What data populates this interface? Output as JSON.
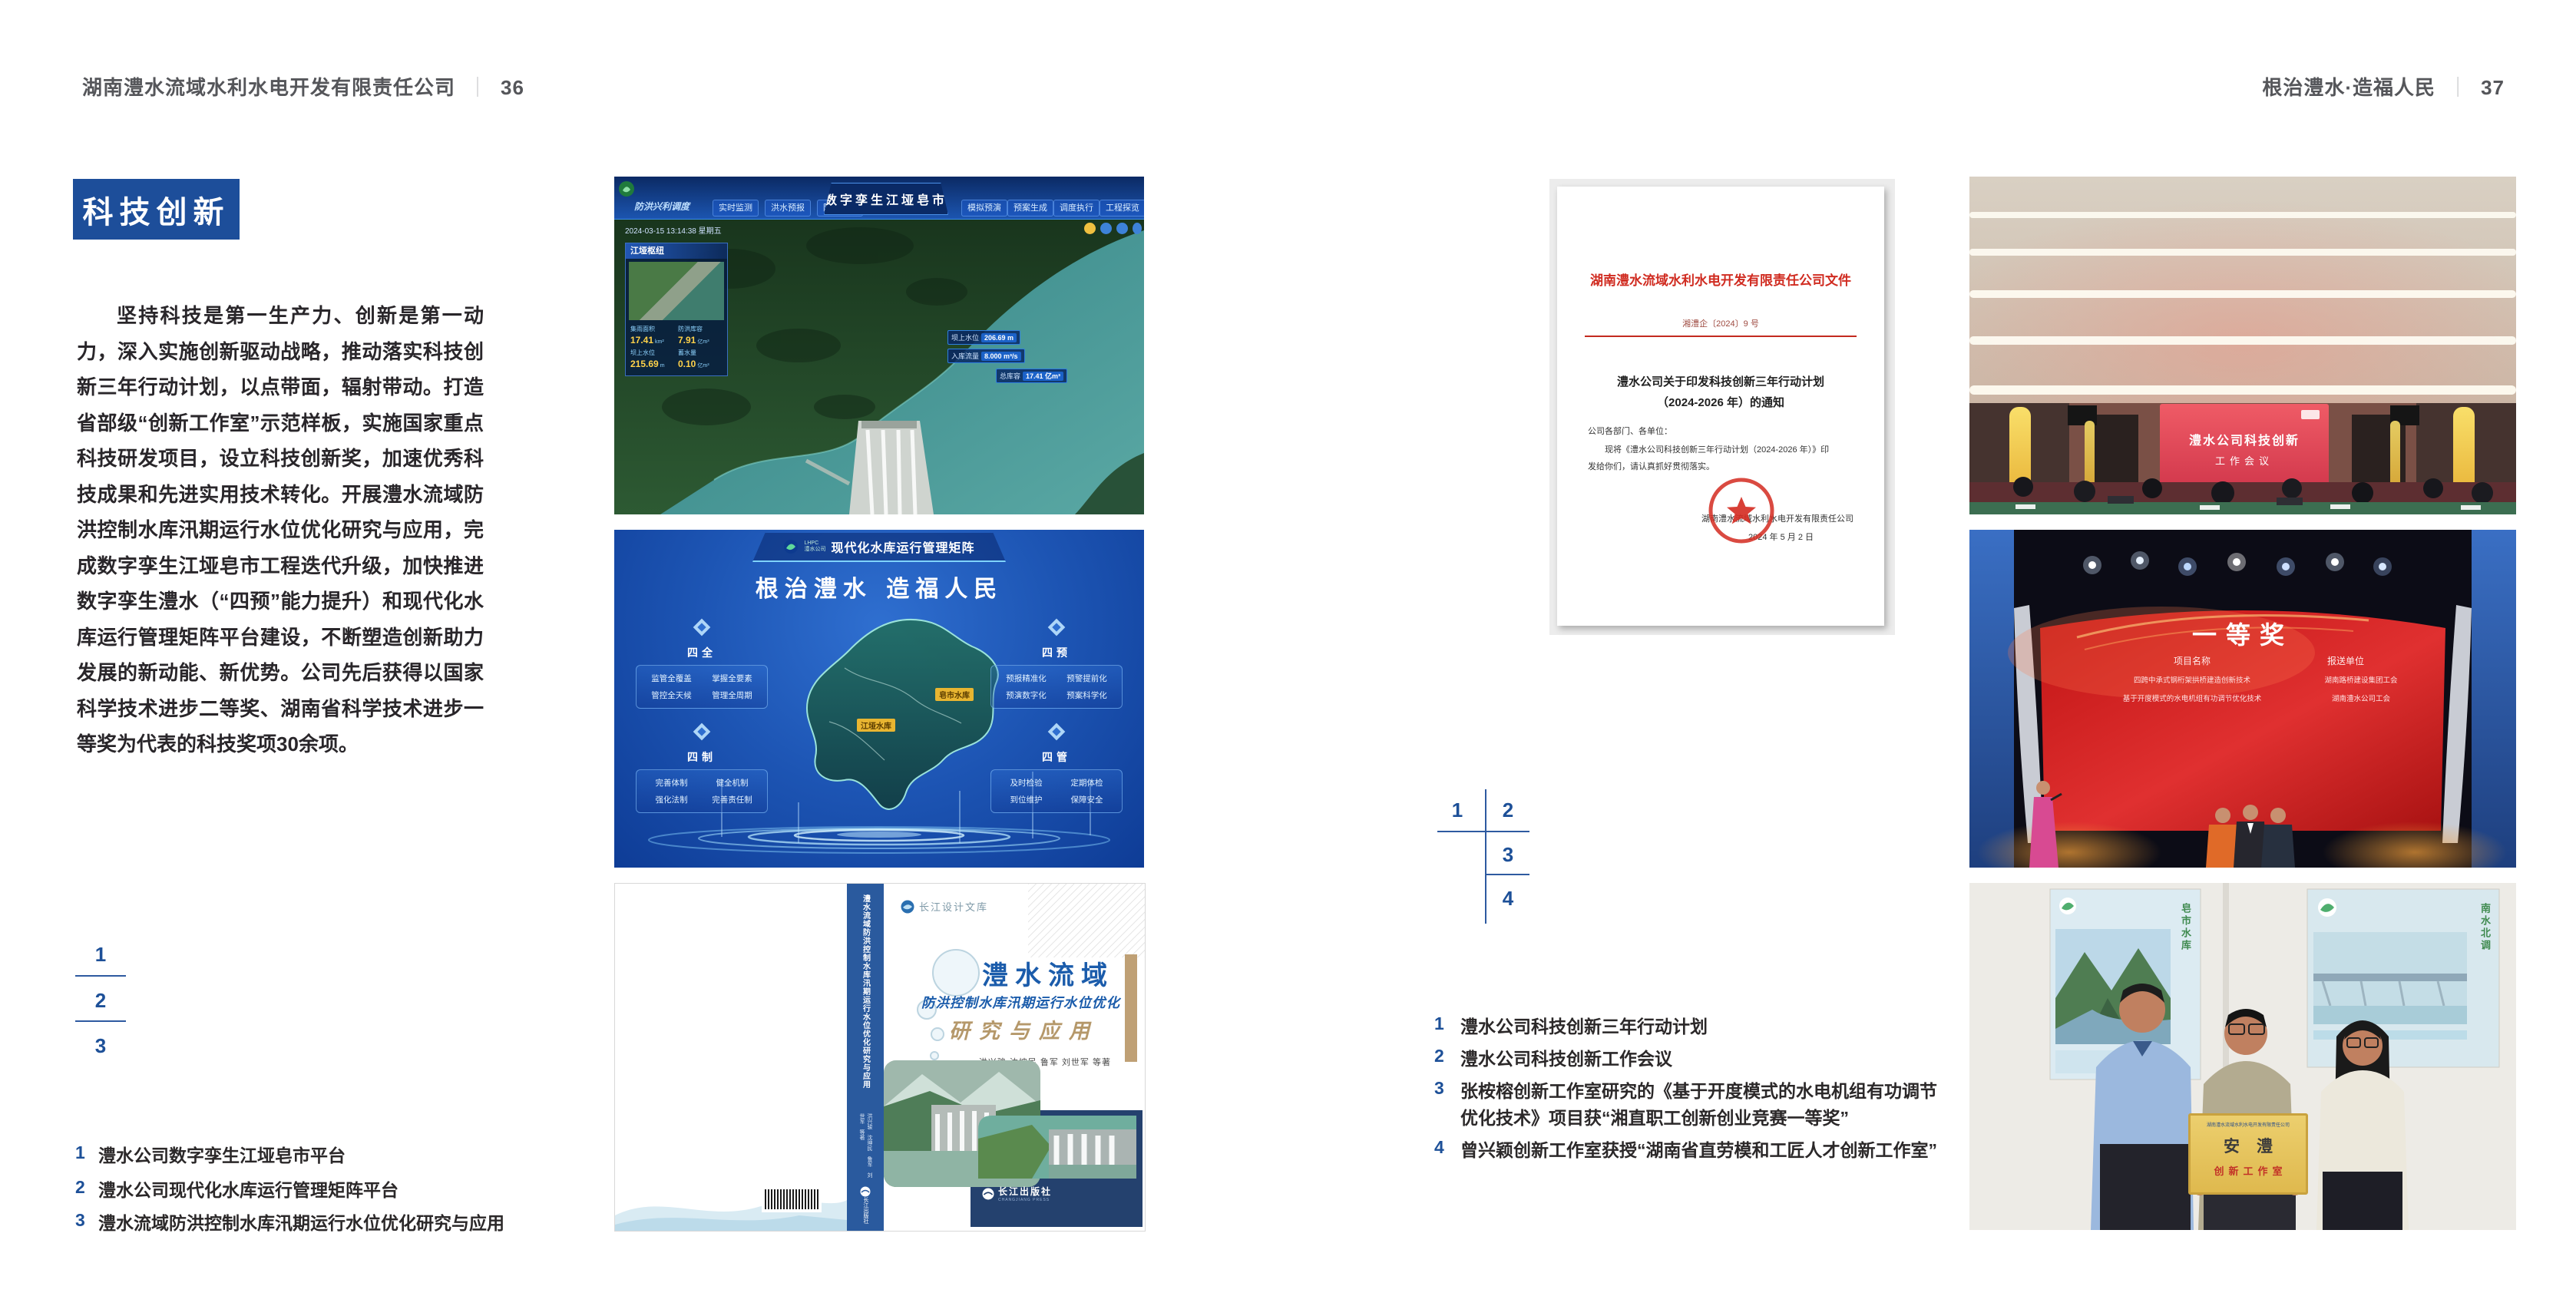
{
  "colors": {
    "accent_blue": "#1d4e9a",
    "index_blue": "#1d5098",
    "doc_red": "#d02b20",
    "map_label_yellow": "#e8b531"
  },
  "page_left": {
    "header": {
      "company": "湖南澧水流域水利水电开发有限责任公司",
      "separator": "｜",
      "page_number": "36"
    },
    "section_title": "科技创新",
    "body_paragraph": "坚持科技是第一生产力、创新是第一动力，深入实施创新驱动战略，推动落实科技创新三年行动计划，以点带面，辐射带动。打造省部级“创新工作室”示范样板，实施国家重点科技研发项目，设立科技创新奖，加速优秀科技成果和先进实用技术转化。开展澧水流域防洪控制水库汛期运行水位优化研究与应用，完成数字孪生江垭皂市工程迭代升级，加快推进数字孪生澧水（“四预”能力提升）和现代化水库运行管理矩阵平台建设，不断塑造创新助力发展的新动能、新优势。公司先后获得以国家科学技术进步二等奖、湖南省科学技术进步一等奖为代表的科技奖项30余项。",
    "figure_index": [
      "1",
      "2",
      "3"
    ],
    "captions": [
      {
        "num": "1",
        "text": "澧水公司数字孪生江垭皂市平台"
      },
      {
        "num": "2",
        "text": "澧水公司现代化水库运行管理矩阵平台"
      },
      {
        "num": "3",
        "text": "澧水流域防洪控制水库汛期运行水位优化研究与应用"
      }
    ],
    "digital_twin": {
      "title": "数字孪生江垭皂市",
      "corner_label": "防洪兴利调度",
      "tabs_left": [
        "实时监测",
        "洪水预报",
        "防洪预警"
      ],
      "tabs_right": [
        "模拟预演",
        "预案生成",
        "调度执行",
        "工程探览"
      ],
      "timestamp": "2024-03-15 13:14:38 星期五",
      "panel": {
        "title": "江垭枢纽",
        "metrics": [
          {
            "label": "集雨面积",
            "value": "17.41",
            "unit": "km²"
          },
          {
            "label": "防洪库容",
            "value": "7.91",
            "unit": "亿m³"
          },
          {
            "label": "坝上水位",
            "value": "215.69",
            "unit": "m"
          },
          {
            "label": "蓄水量",
            "value": "0.10",
            "unit": "亿m³"
          }
        ]
      },
      "chips": [
        {
          "label": "坝上水位",
          "value": "206.69 m"
        },
        {
          "label": "入库流量",
          "value": "8.000 m³/s"
        },
        {
          "label": "总库容",
          "value": "17.41 亿m³"
        }
      ]
    },
    "matrix": {
      "logo_line1": "LHPC",
      "logo_line2": "澧水公司",
      "title": "现代化水库运行管理矩阵",
      "slogan": "根治澧水 造福人民",
      "map_labels": [
        "皂市水库",
        "江垭水库"
      ],
      "groups": [
        {
          "name": "四全",
          "items": [
            "监管全覆盖",
            "掌握全要素",
            "管控全天候",
            "管理全周期"
          ]
        },
        {
          "name": "四预",
          "items": [
            "预报精准化",
            "预警提前化",
            "预演数字化",
            "预案科学化"
          ]
        },
        {
          "name": "四制",
          "items": [
            "完善体制",
            "健全机制",
            "强化法制",
            "完善责任制"
          ]
        },
        {
          "name": "四管",
          "items": [
            "及时检验",
            "定期体检",
            "到位维护",
            "保障安全"
          ]
        }
      ]
    },
    "book": {
      "series": "长江设计文库",
      "title_main": "澧水流域",
      "title_sub": "防洪控制水库汛期运行水位优化",
      "title_tail": "研究与应用",
      "authors": "洪兴骏  沈坤民  鲁军  刘世军  等著",
      "spine_title": "澧水流域防洪控制水库汛期运行水位优化研究与应用",
      "spine_authors": "洪兴骏 沈坤民 鲁军 刘世军 等著",
      "spine_publisher": "长江出版社",
      "publisher": "长江出版社",
      "publisher_en": "CHANGJIANG PRESS"
    }
  },
  "page_right": {
    "header": {
      "slogan": "根治澧水·造福人民",
      "separator": "｜",
      "page_number": "37"
    },
    "document": {
      "red_head": "湖南澧水流域水利水电开发有限责任公司文件",
      "doc_number": "湘澧企〔2024〕9 号",
      "title_line1": "澧水公司关于印发科技创新三年行动计划",
      "title_line2": "（2024-2026 年）的通知",
      "salutation": "公司各部门、各单位：",
      "body_line1": "现将《澧水公司科技创新三年行动计划（2024-2026 年）》印",
      "body_line2": "发给你们，请认真抓好贯彻落实。",
      "signer": "湖南澧水流域水利水电开发有限责任公司",
      "date": "2024 年 5 月 2 日"
    },
    "figure_index": [
      "1",
      "2",
      "3",
      "4"
    ],
    "captions": [
      {
        "num": "1",
        "text": "澧水公司科技创新三年行动计划"
      },
      {
        "num": "2",
        "text": "澧水公司科技创新工作会议"
      },
      {
        "num": "3",
        "text": "张桉榕创新工作室研究的《基于开度模式的水电机组有功调节优化技术》项目获“湘直职工创新创业竞赛一等奖”"
      },
      {
        "num": "4",
        "text": "曾兴颖创新工作室获授“湖南省直劳模和工匠人才创新工作室”"
      }
    ],
    "meeting_photo": {
      "screen_line1": "澧水公司科技创新",
      "screen_line2": "工作会议"
    },
    "award_photo": {
      "title": "一等奖",
      "col1_header": "项目名称",
      "col2_header": "报送单位",
      "rows": [
        {
          "project": "四跨中承式钢桁架拱桥建造创新技术",
          "unit": "湖南路桥建设集团工会"
        },
        {
          "project": "基于开度模式的水电机组有功调节优化技术",
          "unit": "湖南澧水公司工会"
        }
      ]
    },
    "group_photo": {
      "plaque_header": "湖南澧水流域水利水电开发有限责任公司",
      "plaque_title": "安澧",
      "plaque_subtitle": "创新工作室",
      "poster_left_label": "皂市水库",
      "poster_right_label": "南水北调"
    }
  }
}
